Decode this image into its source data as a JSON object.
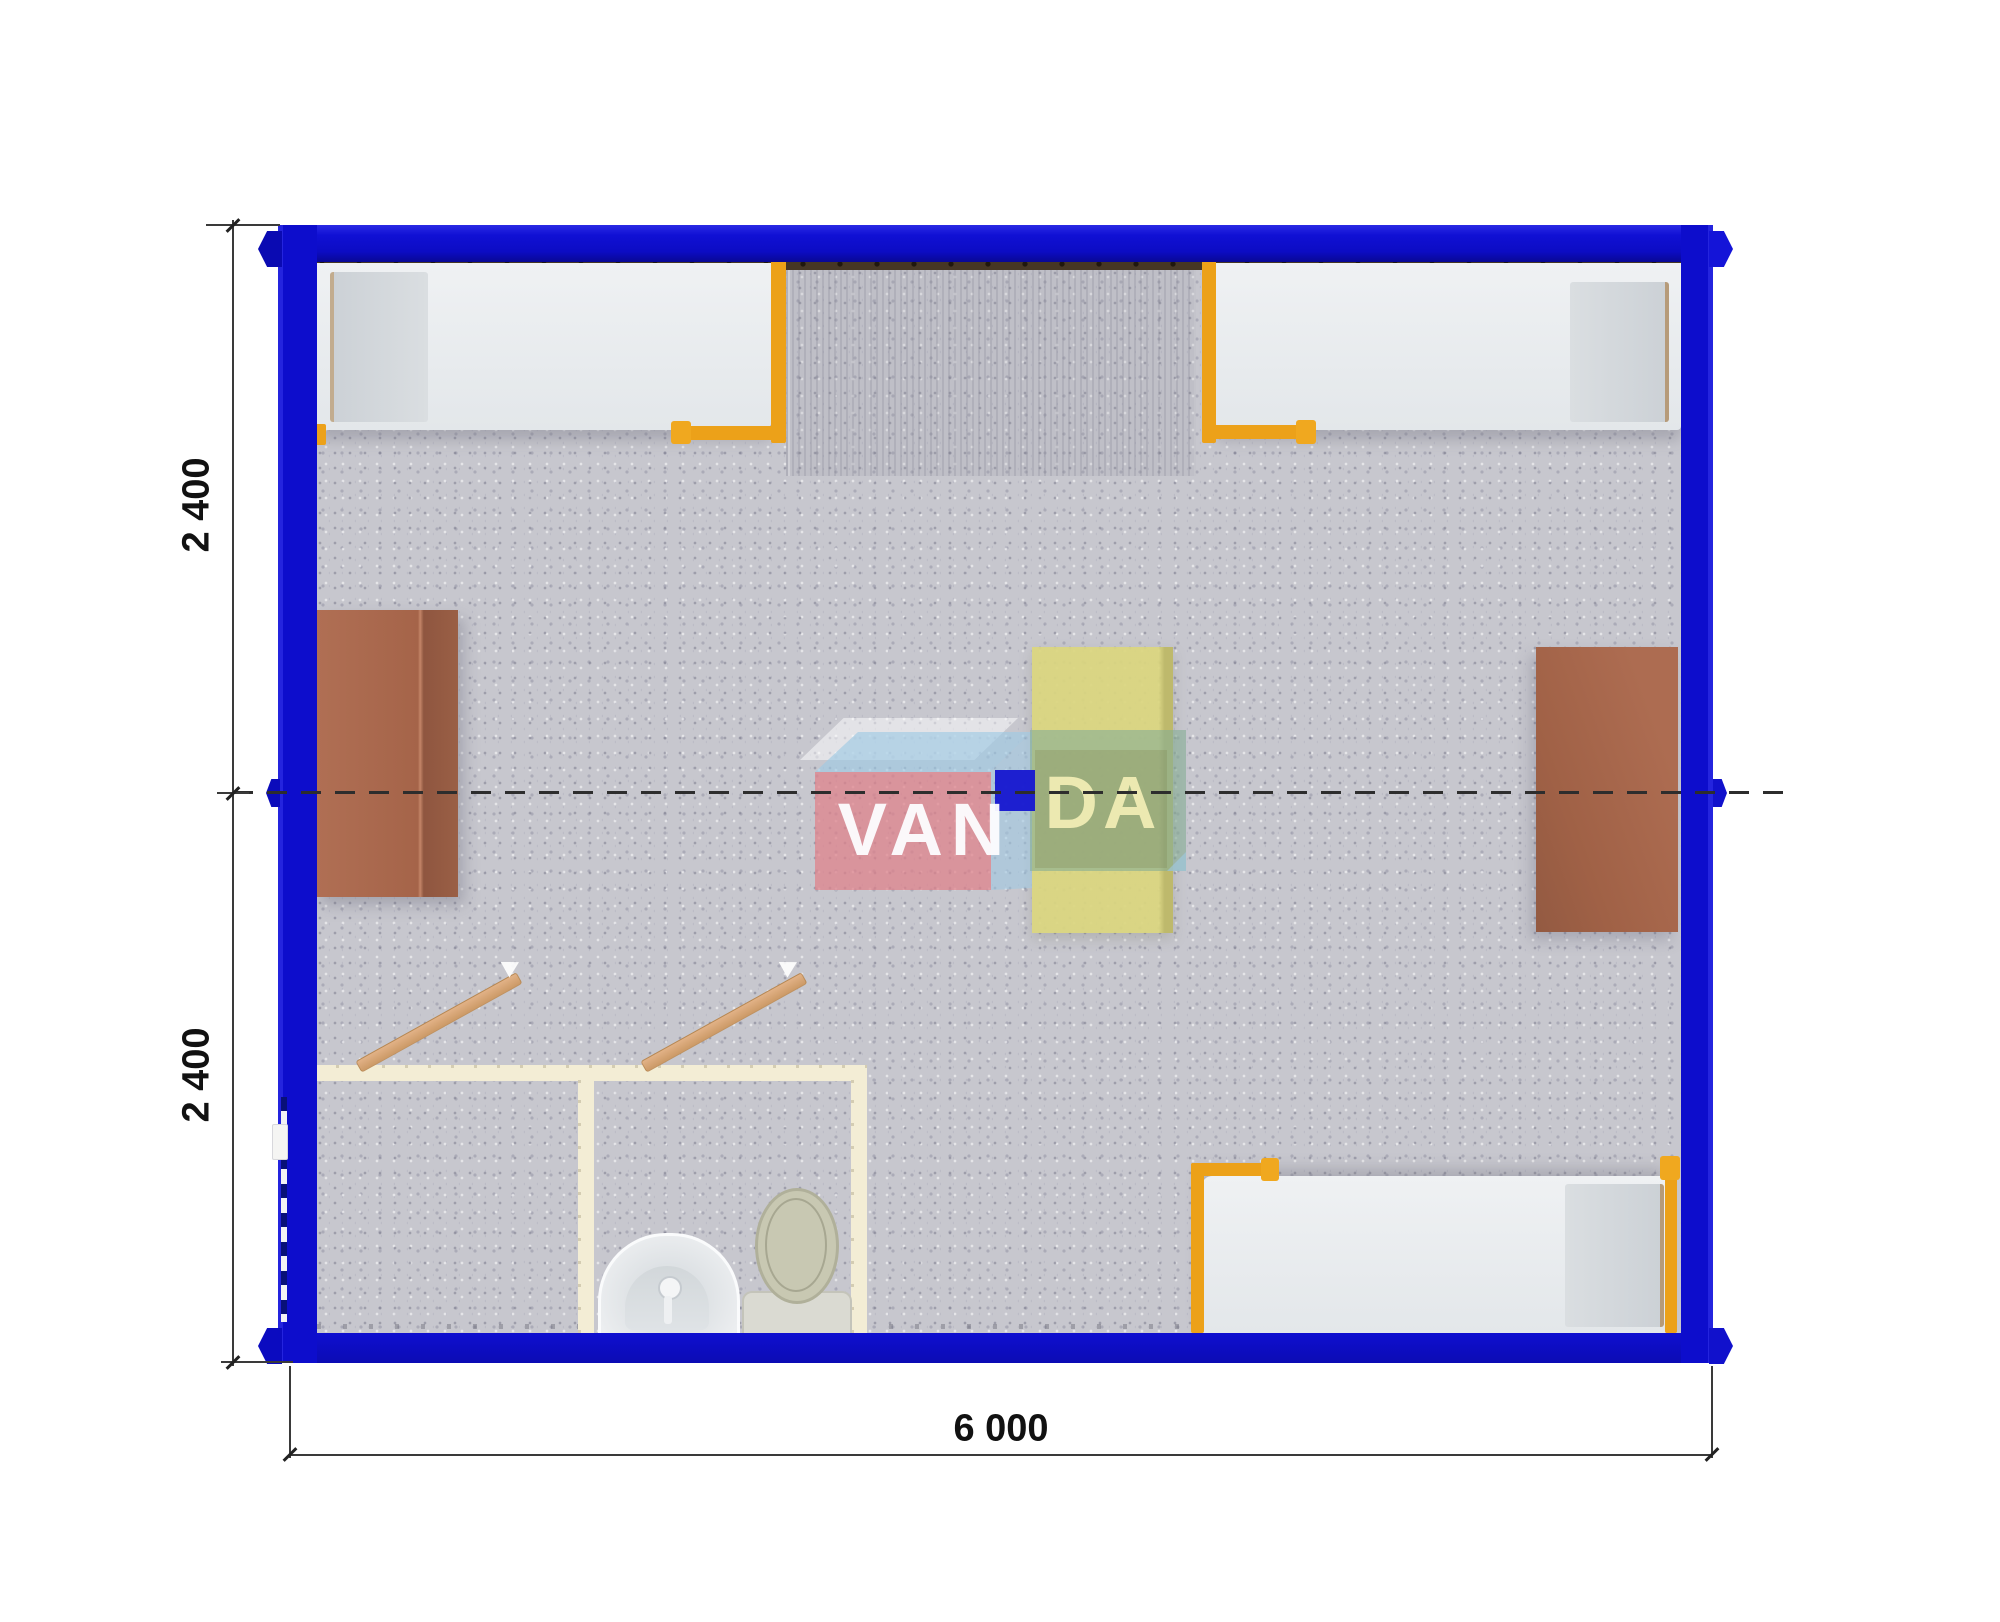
{
  "drawing": {
    "title": "container-building-floor-plan",
    "dimensions": {
      "side_upper_module": "2 400",
      "side_lower_module": "2 400",
      "bottom_total": "6 000"
    },
    "watermark": {
      "left_text": "VAN",
      "right_text": "DA"
    },
    "colors": {
      "frame_blue": "#0d0dcc",
      "accent_orange": "#eca119",
      "table_brown": "#a8684e",
      "table_yellow": "#d8d377",
      "floor_gray": "#c7c7ce",
      "wall_cream": "#f3edd5",
      "logo_pink": "#df818b",
      "logo_green": "#85ad94",
      "logo_sky": "#a0cae4",
      "logo_blue": "#1516d0"
    }
  }
}
